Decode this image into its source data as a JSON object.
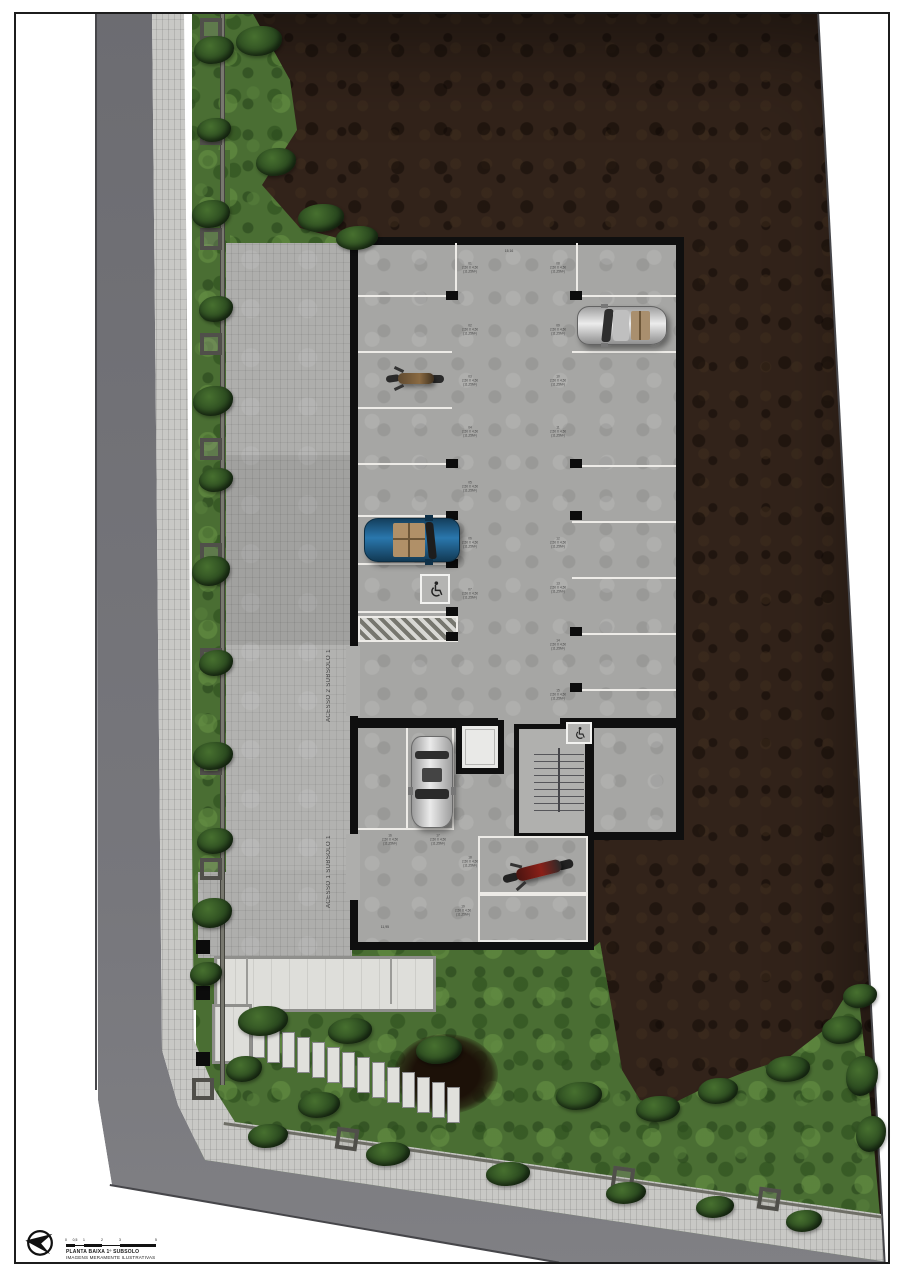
{
  "title_block": {
    "plan_title": "PLANTA BAIXA 1º SUBSOLO",
    "disclaimer": "IMAGENS MERAMENTE ILUSTRATIVAS",
    "scale_ticks": [
      "0",
      "0,5",
      "1",
      "2",
      "3",
      "5"
    ]
  },
  "plan_labels": {
    "access_2": "ACESSO 2 SUBSOLO 1",
    "access_1": "ACESSO 1 SUBSOLO 1",
    "garage_top_dim": "15,16",
    "garage_bottom_dim": "11,95"
  },
  "colors": {
    "earth": "#32231a",
    "grass": "#4a6e33",
    "road": "#707075",
    "sidewalk": "#c8c8c5",
    "court_paving": "#aeaeac",
    "garage_floor": "#a6a6a4",
    "wall": "#0f0f0f",
    "stall_line": "#edebe7",
    "blue_car": "#1e5e8c",
    "red_moto": "#8a2018"
  },
  "stalls": [
    {
      "x": 470,
      "y": 268,
      "num": "01",
      "dim": "2,50 X 4,50",
      "area": "(11,25M²)"
    },
    {
      "x": 470,
      "y": 330,
      "num": "02",
      "dim": "2,50 X 4,50",
      "area": "(11,25M²)"
    },
    {
      "x": 470,
      "y": 381,
      "num": "03",
      "dim": "2,50 X 4,50",
      "area": "(11,25M²)"
    },
    {
      "x": 470,
      "y": 432,
      "num": "04",
      "dim": "2,50 X 4,50",
      "area": "(11,25M²)"
    },
    {
      "x": 470,
      "y": 487,
      "num": "05",
      "dim": "2,50 X 4,50",
      "area": "(11,25M²)"
    },
    {
      "x": 470,
      "y": 543,
      "num": "06",
      "dim": "2,50 X 4,50",
      "area": "(11,25M²)"
    },
    {
      "x": 470,
      "y": 594,
      "num": "07",
      "dim": "2,50 X 4,50",
      "area": "(11,25M²)"
    },
    {
      "x": 558,
      "y": 268,
      "num": "08",
      "dim": "2,50 X 4,50",
      "area": "(11,25M²)"
    },
    {
      "x": 558,
      "y": 330,
      "num": "09",
      "dim": "2,50 X 4,50",
      "area": "(11,25M²)"
    },
    {
      "x": 558,
      "y": 381,
      "num": "10",
      "dim": "2,50 X 4,50",
      "area": "(11,25M²)"
    },
    {
      "x": 558,
      "y": 432,
      "num": "11",
      "dim": "2,50 X 4,50",
      "area": "(11,25M²)"
    },
    {
      "x": 558,
      "y": 543,
      "num": "12",
      "dim": "2,50 X 4,50",
      "area": "(11,25M²)"
    },
    {
      "x": 558,
      "y": 588,
      "num": "13",
      "dim": "2,50 X 4,50",
      "area": "(11,25M²)"
    },
    {
      "x": 558,
      "y": 645,
      "num": "14",
      "dim": "2,50 X 4,50",
      "area": "(11,25M²)"
    },
    {
      "x": 558,
      "y": 695,
      "num": "15",
      "dim": "2,50 X 4,50",
      "area": "(11,25M²)"
    },
    {
      "x": 390,
      "y": 840,
      "num": "16",
      "dim": "2,50 X 4,50",
      "area": "(11,25M²)"
    },
    {
      "x": 438,
      "y": 840,
      "num": "17",
      "dim": "2,50 X 4,50",
      "area": "(11,25M²)"
    },
    {
      "x": 470,
      "y": 862,
      "num": "18",
      "dim": "2,50 X 4,50",
      "area": "(11,25M²)"
    },
    {
      "x": 463,
      "y": 911,
      "num": "19",
      "dim": "2,50 X 4,50",
      "area": "(11,25M²)"
    }
  ],
  "decor": {
    "bushes": [
      {
        "x": 194,
        "y": 36,
        "w": 40,
        "h": 28
      },
      {
        "x": 197,
        "y": 118,
        "w": 34,
        "h": 24
      },
      {
        "x": 192,
        "y": 200,
        "w": 38,
        "h": 28
      },
      {
        "x": 199,
        "y": 296,
        "w": 34,
        "h": 26
      },
      {
        "x": 193,
        "y": 386,
        "w": 40,
        "h": 30
      },
      {
        "x": 199,
        "y": 468,
        "w": 34,
        "h": 24
      },
      {
        "x": 192,
        "y": 556,
        "w": 38,
        "h": 30
      },
      {
        "x": 199,
        "y": 650,
        "w": 34,
        "h": 26
      },
      {
        "x": 193,
        "y": 742,
        "w": 40,
        "h": 28
      },
      {
        "x": 197,
        "y": 828,
        "w": 36,
        "h": 26
      },
      {
        "x": 192,
        "y": 898,
        "w": 40,
        "h": 30
      },
      {
        "x": 190,
        "y": 962,
        "w": 32,
        "h": 24
      },
      {
        "x": 236,
        "y": 26,
        "w": 46,
        "h": 30
      },
      {
        "x": 256,
        "y": 148,
        "w": 40,
        "h": 28
      },
      {
        "x": 298,
        "y": 204,
        "w": 46,
        "h": 28
      },
      {
        "x": 336,
        "y": 226,
        "w": 42,
        "h": 24
      },
      {
        "x": 238,
        "y": 1006,
        "w": 50,
        "h": 30
      },
      {
        "x": 328,
        "y": 1018,
        "w": 44,
        "h": 26
      },
      {
        "x": 416,
        "y": 1036,
        "w": 46,
        "h": 28
      },
      {
        "x": 298,
        "y": 1092,
        "w": 42,
        "h": 26
      },
      {
        "x": 226,
        "y": 1056,
        "w": 36,
        "h": 26
      },
      {
        "x": 556,
        "y": 1082,
        "w": 46,
        "h": 28
      },
      {
        "x": 636,
        "y": 1096,
        "w": 44,
        "h": 26
      },
      {
        "x": 698,
        "y": 1078,
        "w": 40,
        "h": 26
      },
      {
        "x": 766,
        "y": 1056,
        "w": 44,
        "h": 26
      },
      {
        "x": 822,
        "y": 1016,
        "w": 40,
        "h": 28
      },
      {
        "x": 843,
        "y": 984,
        "w": 34,
        "h": 24
      },
      {
        "x": 846,
        "y": 1056,
        "w": 32,
        "h": 40
      },
      {
        "x": 856,
        "y": 1116,
        "w": 30,
        "h": 36
      },
      {
        "x": 248,
        "y": 1124,
        "w": 40,
        "h": 24
      },
      {
        "x": 366,
        "y": 1142,
        "w": 44,
        "h": 24
      },
      {
        "x": 486,
        "y": 1162,
        "w": 44,
        "h": 24
      },
      {
        "x": 606,
        "y": 1182,
        "w": 40,
        "h": 22
      },
      {
        "x": 696,
        "y": 1196,
        "w": 38,
        "h": 22
      },
      {
        "x": 786,
        "y": 1210,
        "w": 36,
        "h": 22
      }
    ],
    "stones": [
      {
        "x": 252,
        "y": 1022
      },
      {
        "x": 267,
        "y": 1027
      },
      {
        "x": 282,
        "y": 1032
      },
      {
        "x": 297,
        "y": 1037
      },
      {
        "x": 312,
        "y": 1042
      },
      {
        "x": 327,
        "y": 1047
      },
      {
        "x": 342,
        "y": 1052
      },
      {
        "x": 357,
        "y": 1057
      },
      {
        "x": 372,
        "y": 1062
      },
      {
        "x": 387,
        "y": 1067
      },
      {
        "x": 402,
        "y": 1072
      },
      {
        "x": 417,
        "y": 1077
      },
      {
        "x": 432,
        "y": 1082
      },
      {
        "x": 447,
        "y": 1087
      }
    ],
    "wall_pillars": [
      {
        "x": 200,
        "y": 18
      },
      {
        "x": 200,
        "y": 123
      },
      {
        "x": 200,
        "y": 228
      },
      {
        "x": 200,
        "y": 333
      },
      {
        "x": 200,
        "y": 438
      },
      {
        "x": 200,
        "y": 543
      },
      {
        "x": 200,
        "y": 648
      },
      {
        "x": 200,
        "y": 753
      },
      {
        "x": 200,
        "y": 858
      },
      {
        "x": 192,
        "y": 1078
      }
    ],
    "wall_pillars_diag": [
      {
        "x": 336,
        "y": 1128,
        "r": 8
      },
      {
        "x": 612,
        "y": 1167,
        "r": 8
      },
      {
        "x": 758,
        "y": 1188,
        "r": 8
      }
    ],
    "columns": [
      {
        "x": 196,
        "y": 940
      },
      {
        "x": 196,
        "y": 986
      },
      {
        "x": 196,
        "y": 1052
      }
    ]
  }
}
